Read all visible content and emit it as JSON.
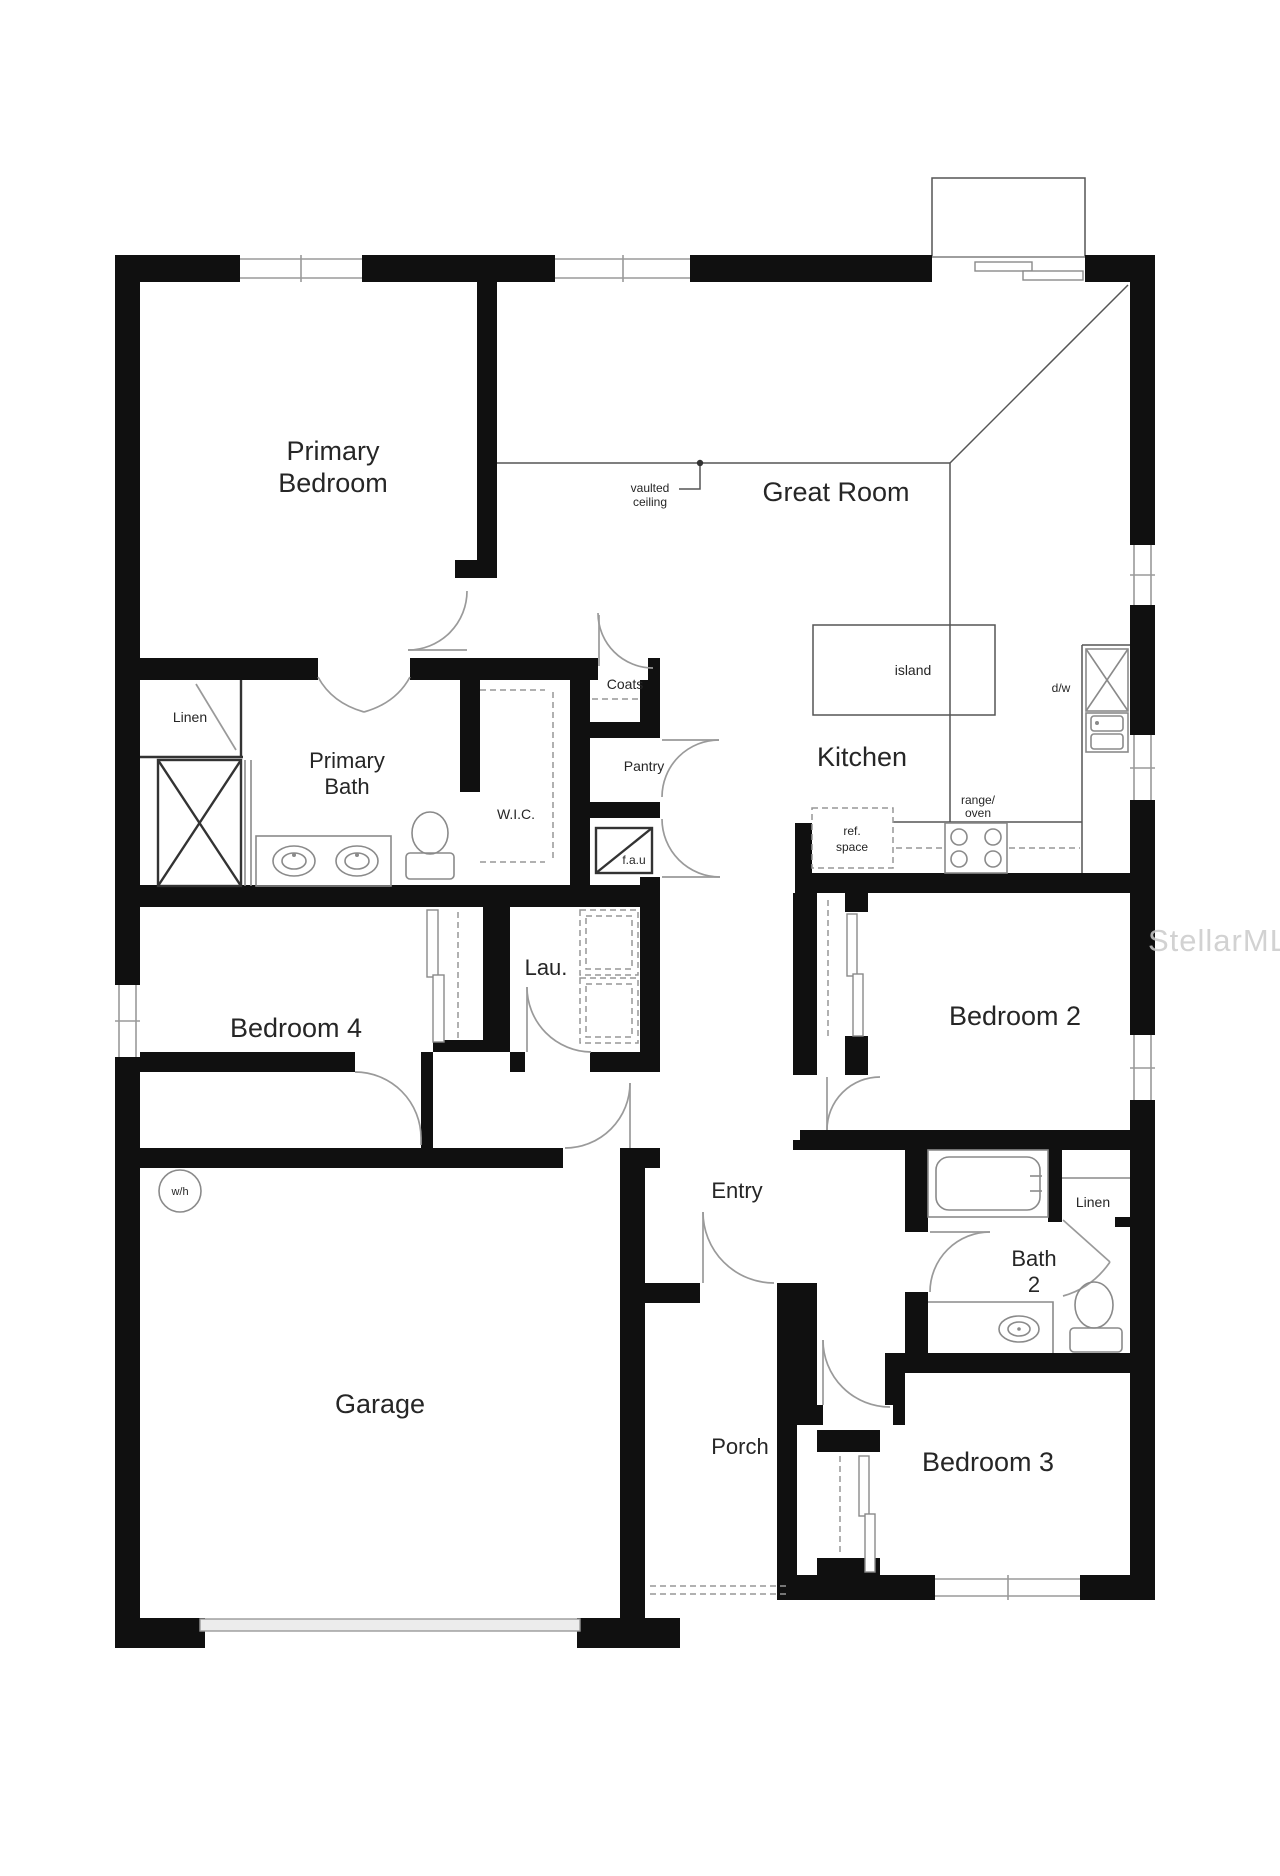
{
  "watermark": {
    "label": "StellarMLS"
  },
  "rooms": {
    "primary_bedroom": {
      "line1": "Primary",
      "line2": "Bedroom"
    },
    "great_room": {
      "label": "Great Room"
    },
    "kitchen": {
      "label": "Kitchen"
    },
    "bedroom2": {
      "label": "Bedroom 2"
    },
    "bedroom3": {
      "label": "Bedroom 3"
    },
    "bedroom4": {
      "label": "Bedroom 4"
    },
    "garage": {
      "label": "Garage"
    },
    "entry": {
      "label": "Entry"
    },
    "porch": {
      "label": "Porch"
    },
    "primary_bath": {
      "line1": "Primary",
      "line2": "Bath"
    },
    "bath2": {
      "line1": "Bath",
      "line2": "2"
    },
    "laundry": {
      "label": "Lau."
    },
    "wic": {
      "label": "W.I.C."
    },
    "coats": {
      "label": "Coats"
    },
    "pantry": {
      "label": "Pantry"
    },
    "linen_primary": {
      "label": "Linen"
    },
    "linen_bath2": {
      "label": "Linen"
    }
  },
  "annotations": {
    "vaulted_ceiling": {
      "line1": "vaulted",
      "line2": "ceiling"
    },
    "island": {
      "label": "island"
    },
    "dishwasher": {
      "label": "d/w"
    },
    "range_oven": {
      "line1": "range/",
      "line2": "oven"
    },
    "ref_space": {
      "line1": "ref.",
      "line2": "space"
    },
    "fau": {
      "label": "f.a.u"
    },
    "water_heater": {
      "label": "w/h"
    }
  },
  "colors": {
    "wall": "#101010",
    "thin_line": "#555555",
    "fixture": "#8a8a8a",
    "label": "#262626",
    "watermark": "#cbcbcb",
    "background": "#ffffff"
  }
}
